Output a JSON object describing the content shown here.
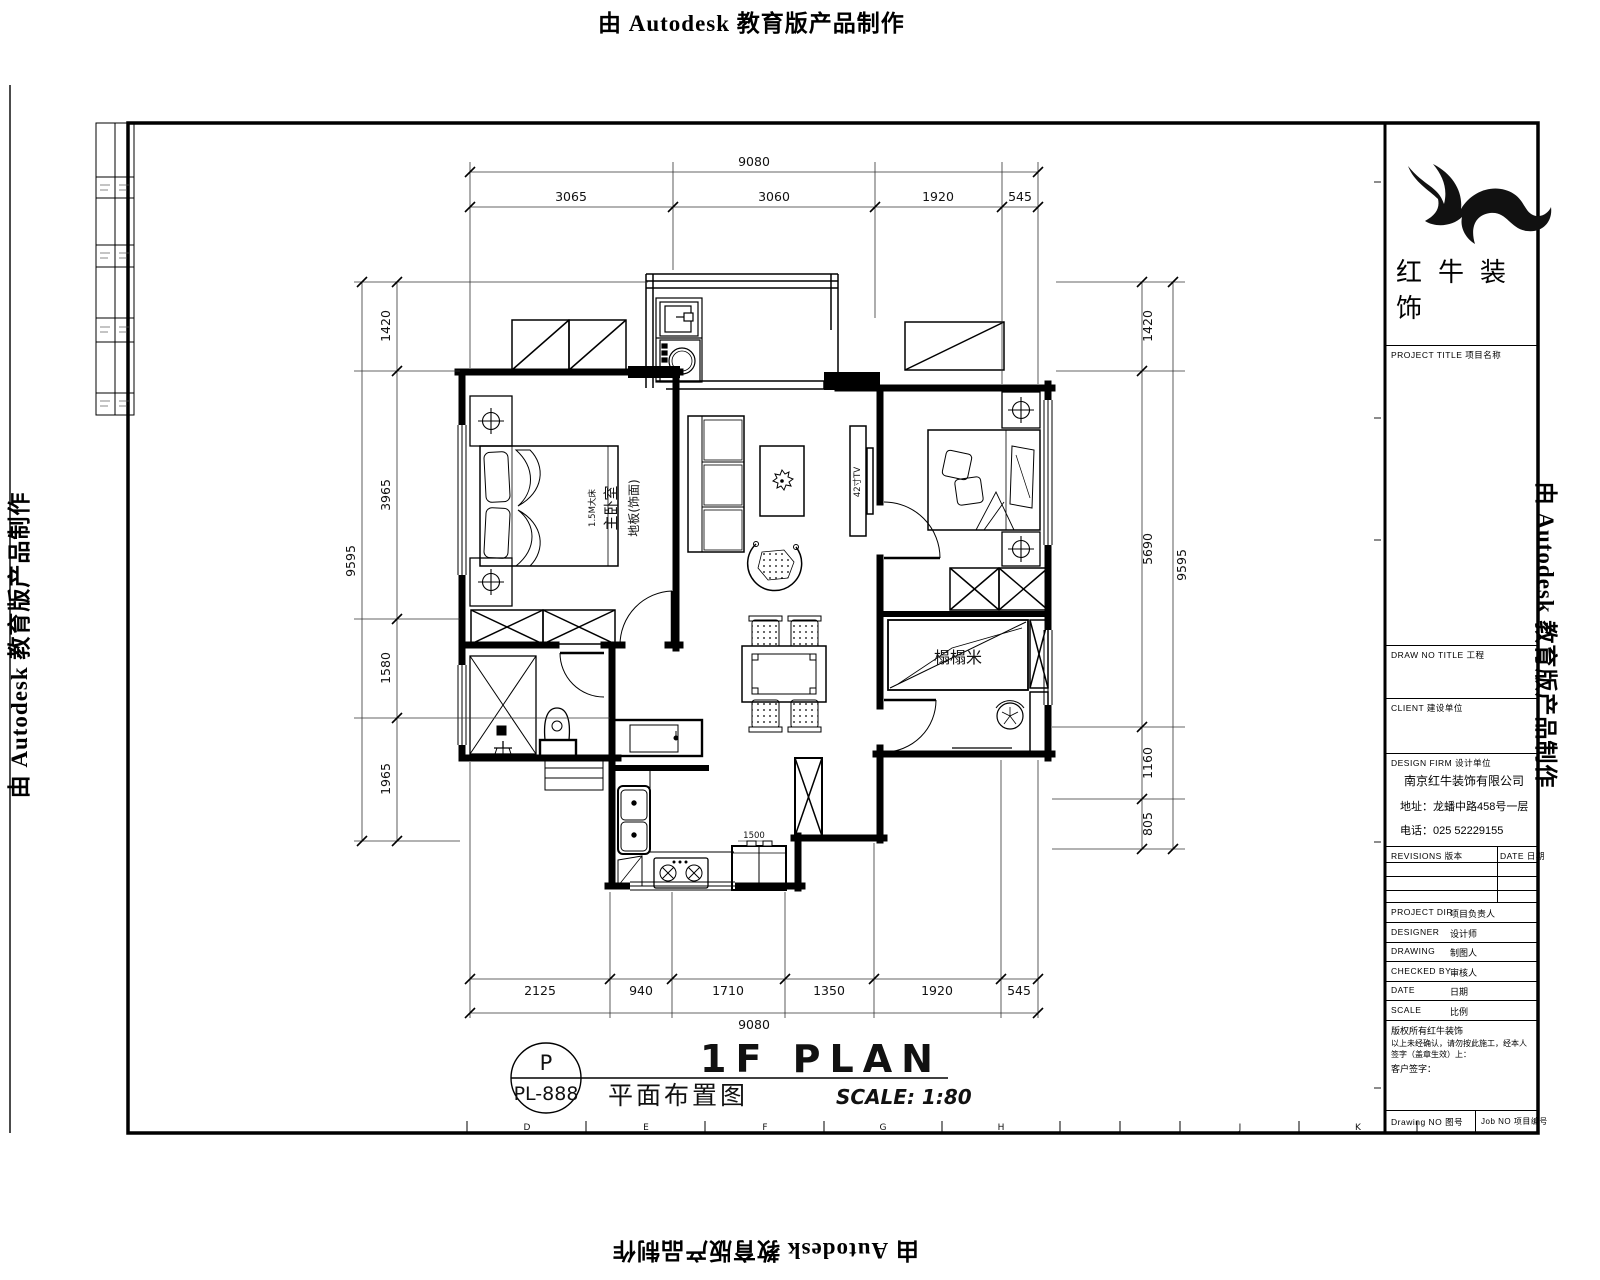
{
  "watermark": {
    "text": "由 Autodesk 教育版产品制作"
  },
  "sheet": {
    "title_en": "1F PLAN",
    "title_cn": "平面布置图",
    "scale_label": "SCALE: 1:80",
    "stamp_letter": "P",
    "stamp_number": "PL-888",
    "grid_letters": [
      "D",
      "E",
      "F",
      "G",
      "H",
      "J",
      "K"
    ]
  },
  "dimensions": {
    "top": {
      "total": "9080",
      "segments": [
        "3065",
        "3060",
        "1920",
        "545"
      ]
    },
    "bottom": {
      "total": "9080",
      "segments": [
        "2125",
        "940",
        "1710",
        "1350",
        "1920",
        "545"
      ]
    },
    "left": {
      "total": "9595",
      "segments": [
        "1420",
        "3965",
        "1580",
        "1965"
      ]
    },
    "right": {
      "total": "9595",
      "segments": [
        "1420",
        "5690",
        "1160",
        "805"
      ]
    }
  },
  "plan_labels": {
    "master_bedroom": "主卧室",
    "master_floor": "地板(饰面)",
    "master_bed": "1.5M大床",
    "tatami": "榻榻米",
    "tv": "42寸TV",
    "counter_dim": "1500"
  },
  "titleblock": {
    "brand": "红牛装饰",
    "sections": {
      "project_title": "PROJECT TITLE  项目名称",
      "drawing_title": "DRAW NO TITLE  工程",
      "client": "CLIENT  建设单位",
      "design_firm": "DESIGN FIRM  设计单位"
    },
    "company": {
      "name": "南京红牛装饰有限公司",
      "address": "地址：龙蟠中路458号一层",
      "phone": "电话：025 52229155"
    },
    "revisions": {
      "rev_header": "REVISIONS 版本",
      "date_header": "DATE 日期"
    },
    "fields": [
      {
        "en": "PROJECT DIR",
        "cn": "项目负责人"
      },
      {
        "en": "DESIGNER",
        "cn": "设计师"
      },
      {
        "en": "DRAWING",
        "cn": "制图人"
      },
      {
        "en": "CHECKED BY",
        "cn": "审核人"
      },
      {
        "en": "DATE",
        "cn": "日期"
      },
      {
        "en": "SCALE",
        "cn": "比例"
      }
    ],
    "notes": {
      "line1": "版权所有红牛装饰",
      "line2": "以上未经确认，请勿按此施工，经本人签字（盖章生效）上：",
      "line3": "客户签字："
    },
    "footer": {
      "left": "Drawing NO 图号",
      "right": "Job NO 项目编号"
    }
  }
}
